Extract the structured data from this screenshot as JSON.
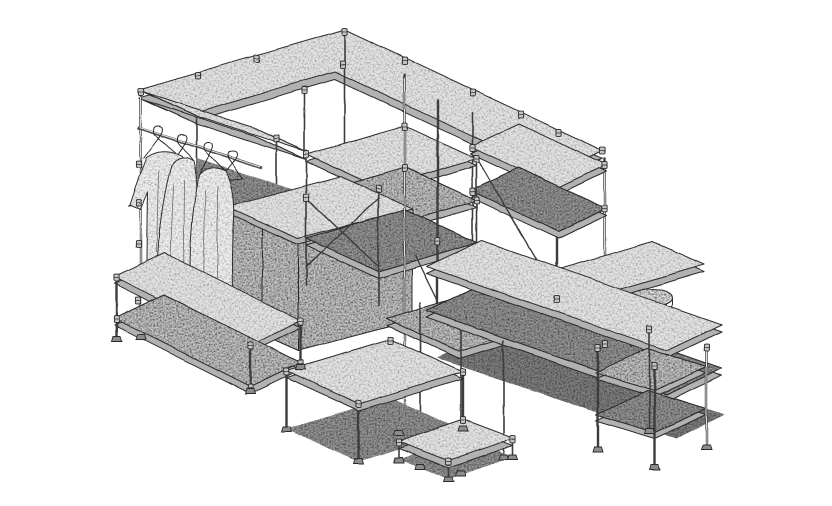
{
  "meta": {
    "title": "Isometric line illustration of a modular pipe-and-clamp shelving system",
    "style": "stippled black-ink technical drawing on white"
  },
  "figure": {
    "alt": "Hand-stippled isometric drawing of a modular retail shelving installation built from pipes, clamp fittings and speckled boards: an overhead U-shaped shelf band, a garment rail with three hanging dresses, a sliding-door cabinet, a central multi-tier shelf tower with cross braces, low display tables, an L-shaped counter run ending in a three-tier shelf unit, and a small round three-legged stool.",
    "width": 832,
    "height": 506
  },
  "palette": {
    "background": "#ffffff",
    "ink": "#2b2b2b",
    "pipe": "#3d3d3d",
    "board_light": "#e4e4e4",
    "board_mid": "#c9c9c9",
    "edge_strip": "#b2b2b2",
    "shadow_dark": "#9a9a9a",
    "shadow_deep": "#848484",
    "garment": "#efefef"
  },
  "scene": {
    "components": [
      {
        "id": "top-shelf-band",
        "label": "Overhead U-shaped shelf band with short front arm"
      },
      {
        "id": "under-band-shelves",
        "label": "Two shelves suspended under the right band run"
      },
      {
        "id": "garment-rack",
        "label": "Garment rail with hangers and three hanging dresses"
      },
      {
        "id": "sliding-door-cabinet",
        "label": "Low cabinet with two sliding doors"
      },
      {
        "id": "mid-shelf-tower",
        "label": "Central multi-tier shelf tower with cross braces"
      },
      {
        "id": "left-low-shelves",
        "label": "Two-tier low shelf under the garment rack"
      },
      {
        "id": "front-display-tables",
        "label": "Two low display tables at the front"
      },
      {
        "id": "counter-run",
        "label": "L-shaped mid-height counter run"
      },
      {
        "id": "right-shelf-unit",
        "label": "Three-tier shelf unit at the right end"
      },
      {
        "id": "stool",
        "label": "Round three-legged stool"
      }
    ],
    "counts": {
      "garments": 3,
      "hangers": 4,
      "stool_legs": 3
    }
  }
}
